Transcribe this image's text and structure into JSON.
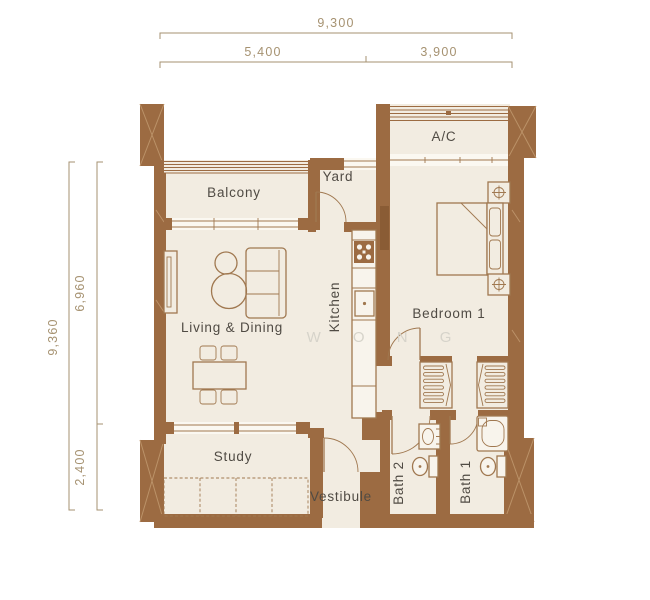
{
  "plan": {
    "watermark": "W O N G",
    "dimensions": {
      "top_total": "9,300",
      "top_left": "5,400",
      "top_right": "3,900",
      "side_total": "9,360",
      "side_upper": "6,960",
      "side_lower": "2,400"
    },
    "rooms": {
      "balcony": "Balcony",
      "yard": "Yard",
      "ac": "A/C",
      "living_dining": "Living & Dining",
      "kitchen": "Kitchen",
      "bedroom1": "Bedroom 1",
      "study": "Study",
      "vestibule": "Vestibule",
      "bath2": "Bath 2",
      "bath1": "Bath 1"
    },
    "colors": {
      "wall": "#9c6b42",
      "floor": "#f2ece1",
      "line": "#a07850",
      "label": "#504b44",
      "dimension": "#a69271",
      "watermark": "#d6d3ca"
    }
  }
}
